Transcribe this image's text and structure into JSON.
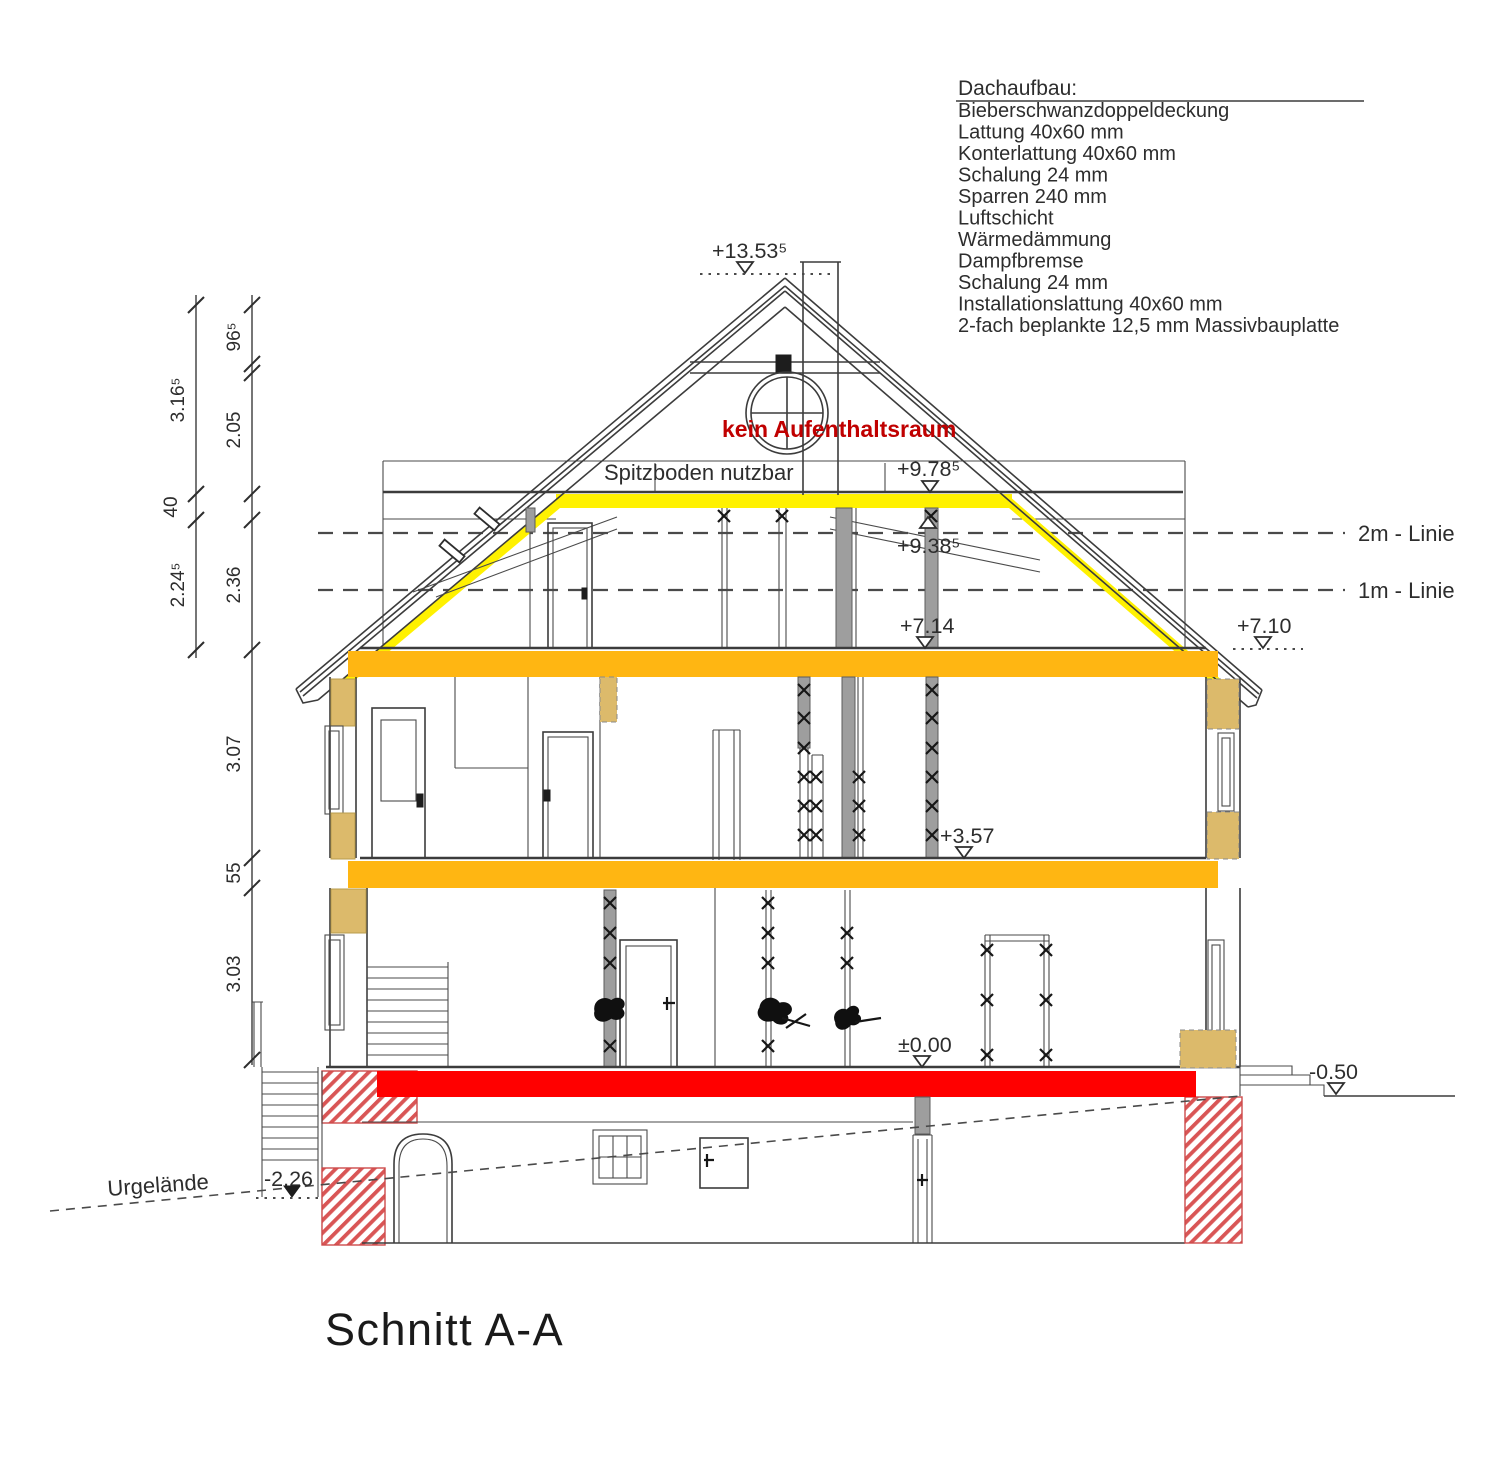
{
  "drawing": {
    "title": "Schnitt A-A"
  },
  "dachaufbau": {
    "heading": "Dachaufbau:",
    "items": [
      "Bieberschwanzdoppeldeckung",
      "Lattung 40x60 mm",
      "Konterlattung 40x60 mm",
      "Schalung 24 mm",
      "Sparren 240 mm",
      "Luftschicht",
      "Wärmedämmung",
      "Dampfbremse",
      "Schalung 24 mm",
      "Installationslattung 40x60 mm",
      "2-fach beplankte 12,5 mm Massivbauplatte"
    ]
  },
  "levels": {
    "ridge": "+13.53⁵",
    "spitzboden_floor": "+9.78⁵",
    "kehlbalken": "+9.38⁵",
    "dg_floor": "+7.14",
    "dg_floor_right": "+7.10",
    "og_floor": "+3.57",
    "eg_floor": "±0.00",
    "terrain_right": "-0.50",
    "keller_entrance": "-2.26"
  },
  "reference_lines": {
    "two_m_line": "2m - Linie",
    "one_m_line": "1m - Linie"
  },
  "annotations": {
    "no_occupancy": "kein Aufenthaltsraum",
    "spitzboden_usable": "Spitzboden nutzbar",
    "original_terrain": "Urgelände"
  },
  "dimensions": {
    "outer_chain": [
      "3.16⁵",
      "40",
      "2.24⁵"
    ],
    "inner_chain": [
      "96⁵",
      "2.05",
      "2.36",
      "3.07",
      "55",
      "3.03"
    ]
  },
  "colors": {
    "insulation_yellow": "#FFF100",
    "floor_orange": "#FFB612",
    "slab_red": "#FF0000",
    "wall_tan": "#DCBA6B",
    "hatch_red": "#D95555",
    "note_red": "#C00000"
  }
}
